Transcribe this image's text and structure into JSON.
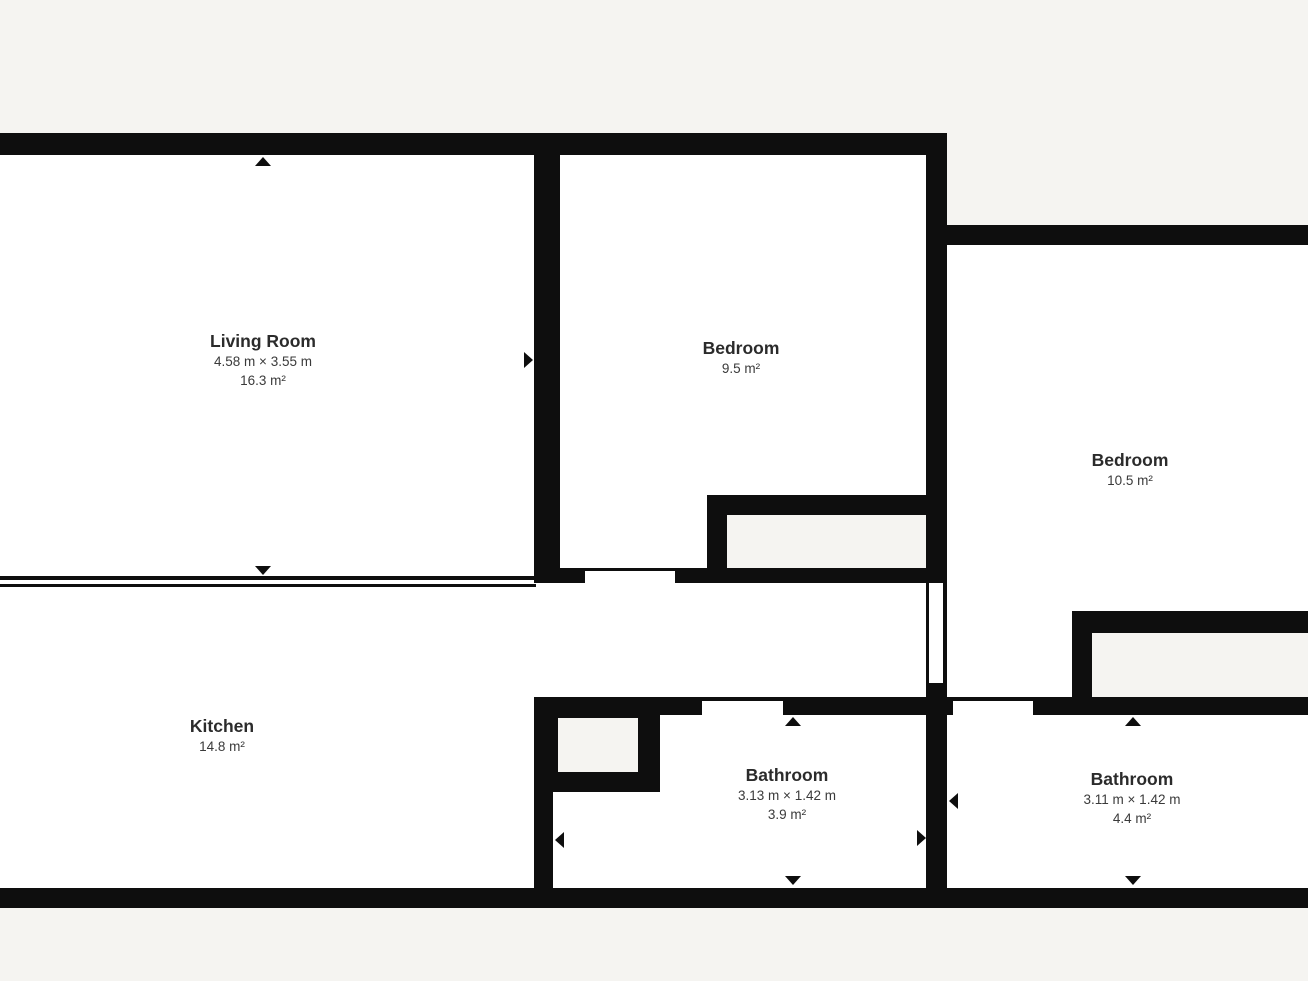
{
  "plan": {
    "rooms": [
      {
        "name": "Living Room",
        "dimensions": "4.58 m × 3.55 m",
        "area": "16.3 m²"
      },
      {
        "name": "Bedroom",
        "dimensions": "",
        "area": "9.5 m²"
      },
      {
        "name": "Bedroom",
        "dimensions": "",
        "area": "10.5 m²"
      },
      {
        "name": "Kitchen",
        "dimensions": "",
        "area": "14.8 m²"
      },
      {
        "name": "Bathroom",
        "dimensions": "3.13 m × 1.42 m",
        "area": "3.9 m²"
      },
      {
        "name": "Bathroom",
        "dimensions": "3.11 m × 1.42 m",
        "area": "4.4 m²"
      }
    ],
    "colors": {
      "wall": "#0e0e0e",
      "floor": "#ffffff",
      "background": "#f5f4f1",
      "text": "#2d2d2d"
    }
  }
}
